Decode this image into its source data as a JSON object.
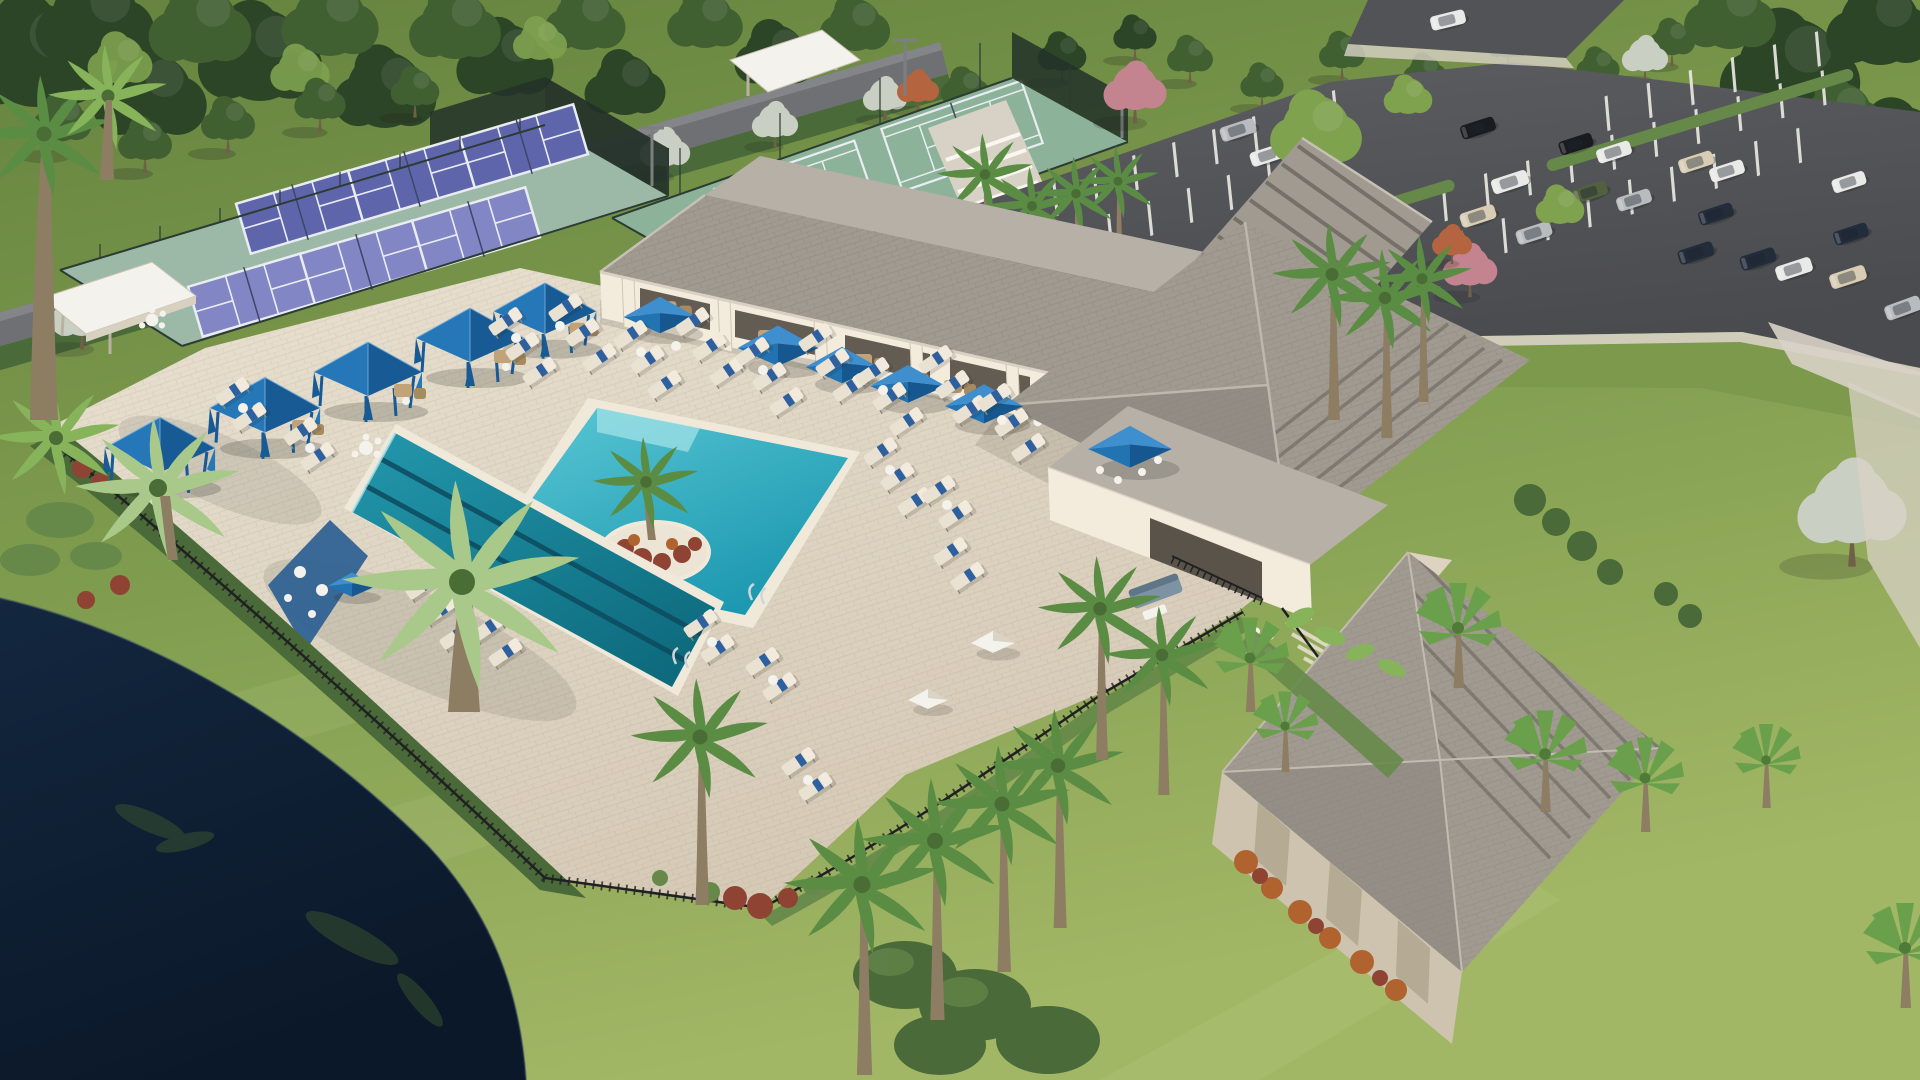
{
  "scene": {
    "title": "Aerial rendering of a resort-style community amenity campus at golden hour",
    "description": "Computer-generated aerial view: a gray hip-roof clubhouse with striped porte-cochere, covered veranda with blue market umbrellas, a turquoise resort pool with a palm island, a three-lane lap pool with a shaded blue sun shelf, rows of chaise lounges with blue towels, five blue pyramid cabanas, six purple pickleball courts and fenced tennis courts, a tree-lined perimeter road with white flowering trees, a full parking lot, a stone-clad outbuilding with fan palms, black aluminum pool fencing with hedges, royal palms, lawns and a dark lake in the foreground corner.",
    "features": {
      "pools": [
        "resort pool with palm island and beach entry",
        "lap pool with two lane lines and shaded blue wet deck"
      ],
      "courts": {
        "pickleball_courts": 6,
        "tennis_courts": 2,
        "court_shade_canopies": 3
      },
      "cabanas": 5,
      "blue_market_umbrellas": 12,
      "white_umbrellas": 2,
      "lounge_chairs_approx": 58,
      "parking": {
        "visible_cars": 20,
        "stall_rows": 3,
        "palm_lined_islands": true
      },
      "buildings": [
        "main clubhouse with gray shingle hip roofs",
        "striped porte-cochere entry canopy",
        "poolside bar pavilion with black railing",
        "stone-clad outbuilding"
      ],
      "landscape": [
        "dark lake with palm reflections",
        "royal palms",
        "fan palms",
        "white flowering trees along perimeter road",
        "pink and orange flowering trees",
        "trimmed hedges",
        "red croton shrubs",
        "black aluminum pool fence",
        "manicured lawns"
      ]
    },
    "lighting": "warm low-angle sunlight from upper right, long soft shadows toward lower left",
    "camera": "high oblique aerial, approximately 40 degree tilt"
  },
  "colors": {
    "grassDeep": "#5e7a3c",
    "grassMid": "#7d9a4c",
    "grassLight": "#a3b869",
    "treeDark": "#2d4527",
    "treeMid": "#416032",
    "treeLight": "#5f8140",
    "treeBright": "#7fa24f",
    "flowerWhite": "#c9cfc2",
    "pinkBloom": "#c4848f",
    "orangeBloom": "#b4643e",
    "roadGray": "#6f7073",
    "asphalt": "#525356",
    "stripeWhite": "#e9e7e1",
    "curb": "#d8d2c6",
    "deck": "#ded4c2",
    "deckLight": "#ece4d4",
    "coping": "#f0e9da",
    "resortPool": "#2fb3c6",
    "resortPoolDeep": "#1b95ad",
    "resortShallow": "#a8e4e8",
    "lapPool": "#1d8fa4",
    "lapPoolDeep": "#0f6d80",
    "laneNavy": "#0d4a5e",
    "wetDeckBlue": "#2d5f93",
    "lake": "#0e1e33",
    "reflectGreen": "#3a512f",
    "roofLight": "#b6b0a6",
    "roofMid": "#a09a90",
    "roofDark": "#86817a",
    "roofRidge": "#5f5b55",
    "wallCream": "#f3ecdd",
    "wallShade": "#ddd3c0",
    "interior": "#3e382f",
    "stone": "#cdc3af",
    "stoneDark": "#b5aa94",
    "fenceBlack": "#202022",
    "fenceCourt": "#2c3b33",
    "windscreen": "#233129",
    "courtSage": "#9cb9a8",
    "tennisSage": "#8db29a",
    "courtPurple": "#5f65ab",
    "courtPurpleLt": "#8286c4",
    "courtLine": "#e9edf2",
    "cabana": "#2677b8",
    "cabanaDark": "#175a94",
    "umbLight": "#3f8fcf",
    "umbMid": "#2273b2",
    "umbDark": "#16578f",
    "towel": "#2e5f9e",
    "lounge": "#e9e1d1",
    "loungeBack": "#f2ebdd",
    "frame": "#8d867a",
    "wicker": "#c2a377",
    "wickerDark": "#a68a60",
    "white": "#f4f2ec",
    "sofa": "#7d93a4",
    "sofaDark": "#5f7689",
    "trunk": "#8d7d62",
    "trunkDark": "#6f6047",
    "palm": "#5a8c44",
    "palmLight": "#87b35b",
    "palmPale": "#a9c98b",
    "fan": "#6aa04b",
    "fanLight": "#8fc261",
    "hedge": "#4a6a39",
    "hedgeLight": "#66894a",
    "crotonRed": "#8f4433",
    "crotonOrange": "#b0622f",
    "shadow": "#20241c",
    "steel": "#cfd6da",
    "carWhite": "#e9e9e7",
    "carSilver": "#b9bcbf",
    "carNavy": "#232c3b",
    "carBlack": "#1a1b1f",
    "carGreen": "#52603f",
    "carTan": "#d8cdb4"
  }
}
